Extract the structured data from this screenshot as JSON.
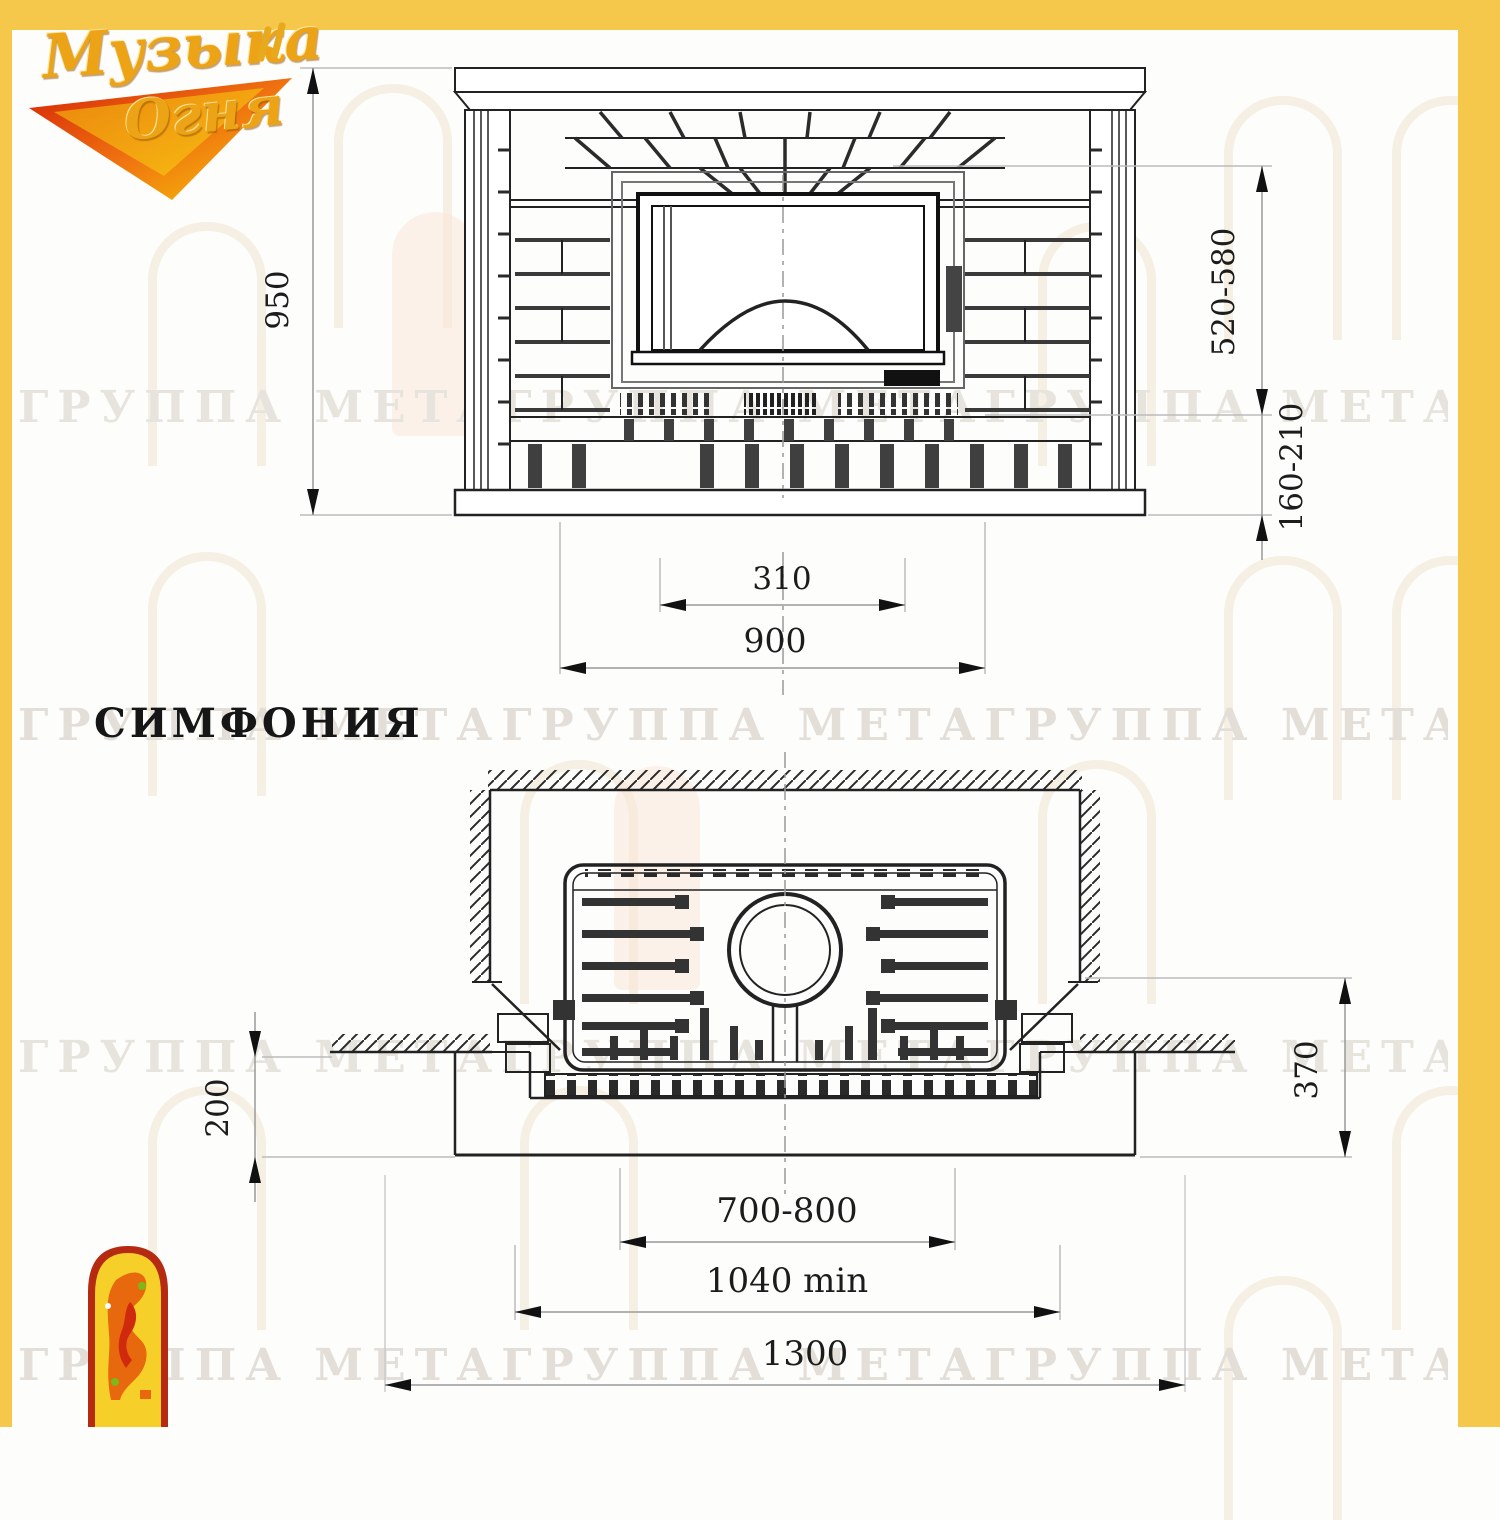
{
  "page": {
    "frame_color": "#f5c84c",
    "background": "#fdfdfc",
    "line_color": "#222222",
    "dim_line_color": "#9a9a9a",
    "watermark_color": "#e7e4de"
  },
  "logo": {
    "word1": "Музыка",
    "word2": "Огня"
  },
  "watermark_text": "ГРУППА МЕТАГРУППА МЕТАГРУППА МЕТАГРУППА МЕТА",
  "model_title": "СИМФОНИЯ",
  "front_view": {
    "label": "front elevation of fireplace",
    "dim_height": "950",
    "dim_firebox_height": "520-580",
    "dim_plinth_height": "160-210",
    "dim_opening_width": "310",
    "dim_body_width": "900"
  },
  "plan_view": {
    "label": "plan section of fireplace in niche",
    "dim_hearth_front": "200",
    "dim_side_depth": "370",
    "dim_insert_width": "700-800",
    "dim_niche_width": "1040 min",
    "dim_overall_width": "1300"
  }
}
